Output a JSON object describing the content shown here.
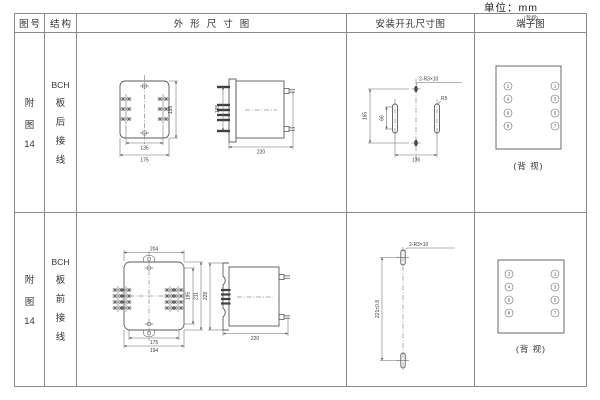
{
  "page": {
    "unit_label": "单位：mm"
  },
  "colors": {
    "table_border": "#8a8a8a",
    "drawing_line": "#5a5a5a",
    "text": "#333333"
  },
  "headers": {
    "fig_no": "图号",
    "structure": "结构",
    "outline": "外形尺寸图",
    "install": "安装开孔尺寸图",
    "terminal": "端子图",
    "terminal_note": "(背视)"
  },
  "rows": [
    {
      "fig": [
        "附",
        "图",
        "14"
      ],
      "structure": [
        "BCH",
        "板",
        "后",
        "接",
        "线"
      ],
      "outline": {
        "front_height": "195",
        "front_inner_width": "136",
        "front_outer_width": "175",
        "side_height": "165",
        "side_depth": "220"
      },
      "install": {
        "total_height": "165",
        "slot_height": "66",
        "hole_spacing": "136",
        "hole_label": "2-R3×10",
        "slot_label": "R5"
      },
      "terminal": {
        "left": [
          "2",
          "4",
          "6",
          "8"
        ],
        "right": [
          "1",
          "3",
          "5",
          "7"
        ],
        "caption": "(背 视)"
      }
    },
    {
      "fig": [
        "附",
        "图",
        "14"
      ],
      "structure": [
        "BCH",
        "板",
        "前",
        "接",
        "线"
      ],
      "outline": {
        "front_top_width": "204",
        "front_inner_height": "195",
        "front_outer_height": "211",
        "front_inner_width": "175",
        "front_outer_width": "194",
        "side_height": "228",
        "side_depth": "220"
      },
      "install": {
        "vertical_spacing": "221±0.8",
        "hole_label": "2-R3×10"
      },
      "terminal": {
        "left": [
          "2",
          "4",
          "6",
          "8"
        ],
        "right": [
          "1",
          "3",
          "5",
          "7"
        ],
        "caption": "(背 视)"
      }
    }
  ]
}
